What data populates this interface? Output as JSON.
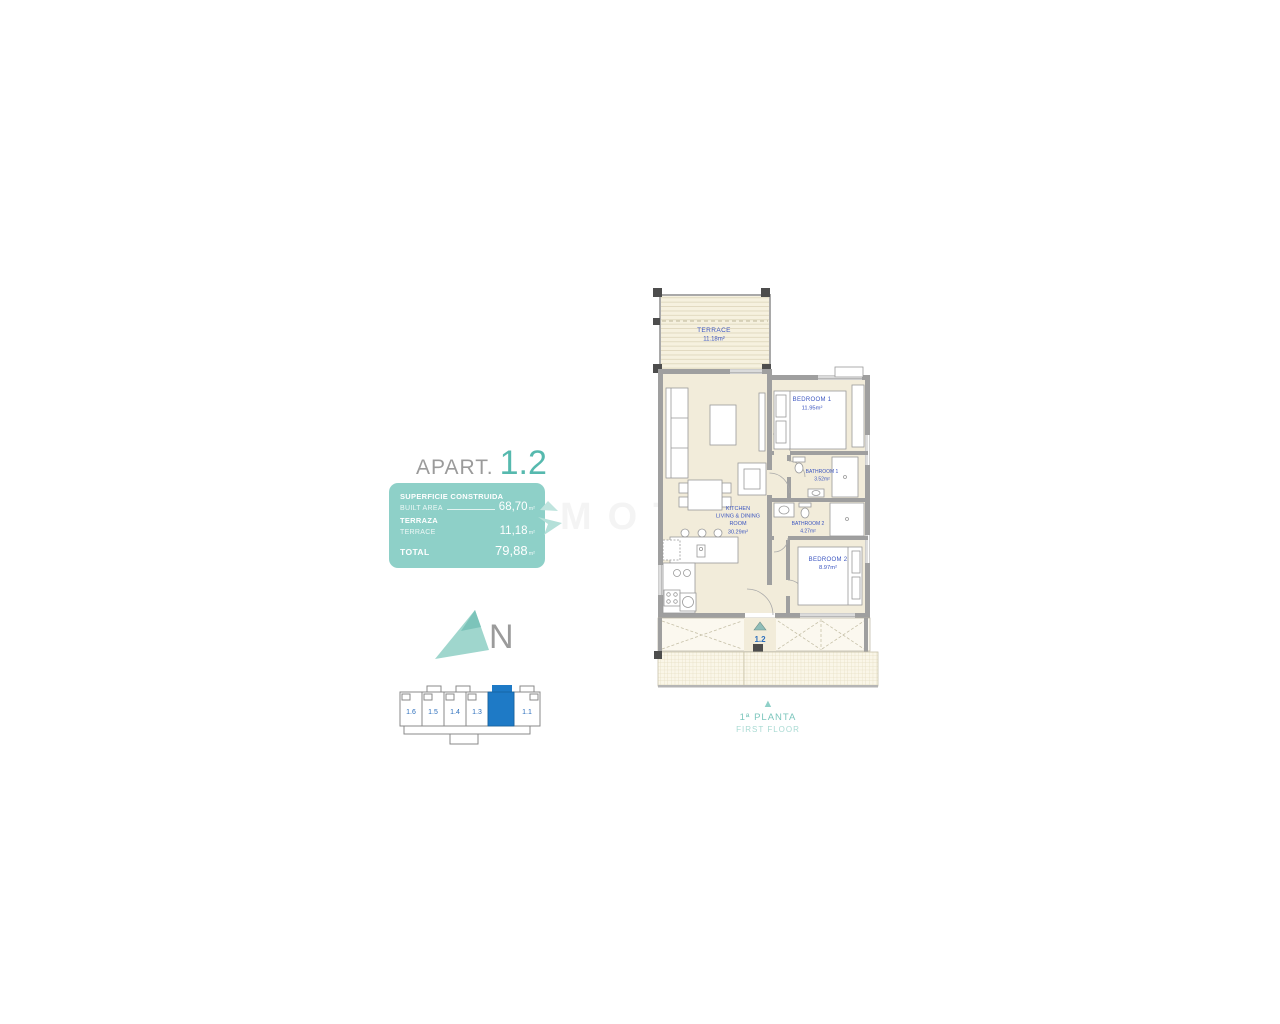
{
  "title": {
    "prefix": "APART.",
    "number": "1.2"
  },
  "summary_box": {
    "built_label_es": "SUPERFICIE CONSTRUIDA",
    "built_label_en": "BUILT AREA",
    "built_value": "68,70",
    "terrace_label_es": "TERRAZA",
    "terrace_label_en": "TERRACE",
    "terrace_value": "11,18",
    "total_label": "TOTAL",
    "total_value": "79,88",
    "unit": "m²"
  },
  "compass": {
    "letter": "N"
  },
  "locator": {
    "units": [
      "1.6",
      "1.5",
      "1.4",
      "1.3",
      "1.1"
    ],
    "highlighted_unit": "1.2"
  },
  "plan": {
    "terrace": {
      "name": "TERRACE",
      "area": "11.18m²"
    },
    "bedroom1": {
      "name": "BEDROOM 1",
      "area": "11.95m²"
    },
    "bathroom1": {
      "name": "BATHROOM 1",
      "area": "3.52m²"
    },
    "kitchen": {
      "line1": "KITCHEN",
      "line2": "LIVING & DINING",
      "line3": "ROOM",
      "area": "30.29m²"
    },
    "bathroom2": {
      "name": "BATHROOM 2",
      "area": "4.27m²"
    },
    "bedroom2": {
      "name": "BEDROOM 2",
      "area": "8.97m²"
    },
    "unit_label": "1.2"
  },
  "floor_label": {
    "es": "1ª PLANTA",
    "en": "FIRST FLOOR"
  },
  "watermark": "MOTION",
  "colors": {
    "teal_box": "#8ed0c8",
    "teal_text": "#56b9ae",
    "room_label_blue": "#3b55c0",
    "locator_blue": "#1e7ac6",
    "floor_cream": "#f2ecda",
    "wall_gray": "#9f9f9f"
  }
}
